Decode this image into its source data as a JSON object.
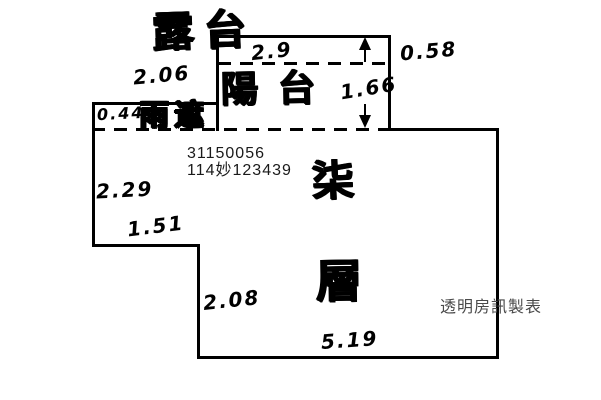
{
  "meta": {
    "type": "hand-drawn floor plan sketch",
    "bg_color": "#ffffff",
    "line_color": "#000000",
    "credit_text_color": "#4a4a4a"
  },
  "labels": {
    "terrace": "露台",
    "balcony": "陽台",
    "rain_canopy": "雨遮",
    "floor_char_1": "柒",
    "floor_char_2": "層"
  },
  "dimensions": {
    "terrace_top_width": "2.9",
    "terrace_depth": "0.58",
    "canopy_top_width": "2.06",
    "canopy_depth": "0.44",
    "balcony_depth": "1.66",
    "left_side_upper": "2.29",
    "left_step_width": "1.51",
    "right_step_height": "2.08",
    "bottom_width": "5.19"
  },
  "ids": {
    "building_number": "31150056",
    "registry_number": "114妙123439"
  },
  "credit": "透明房訊製表"
}
